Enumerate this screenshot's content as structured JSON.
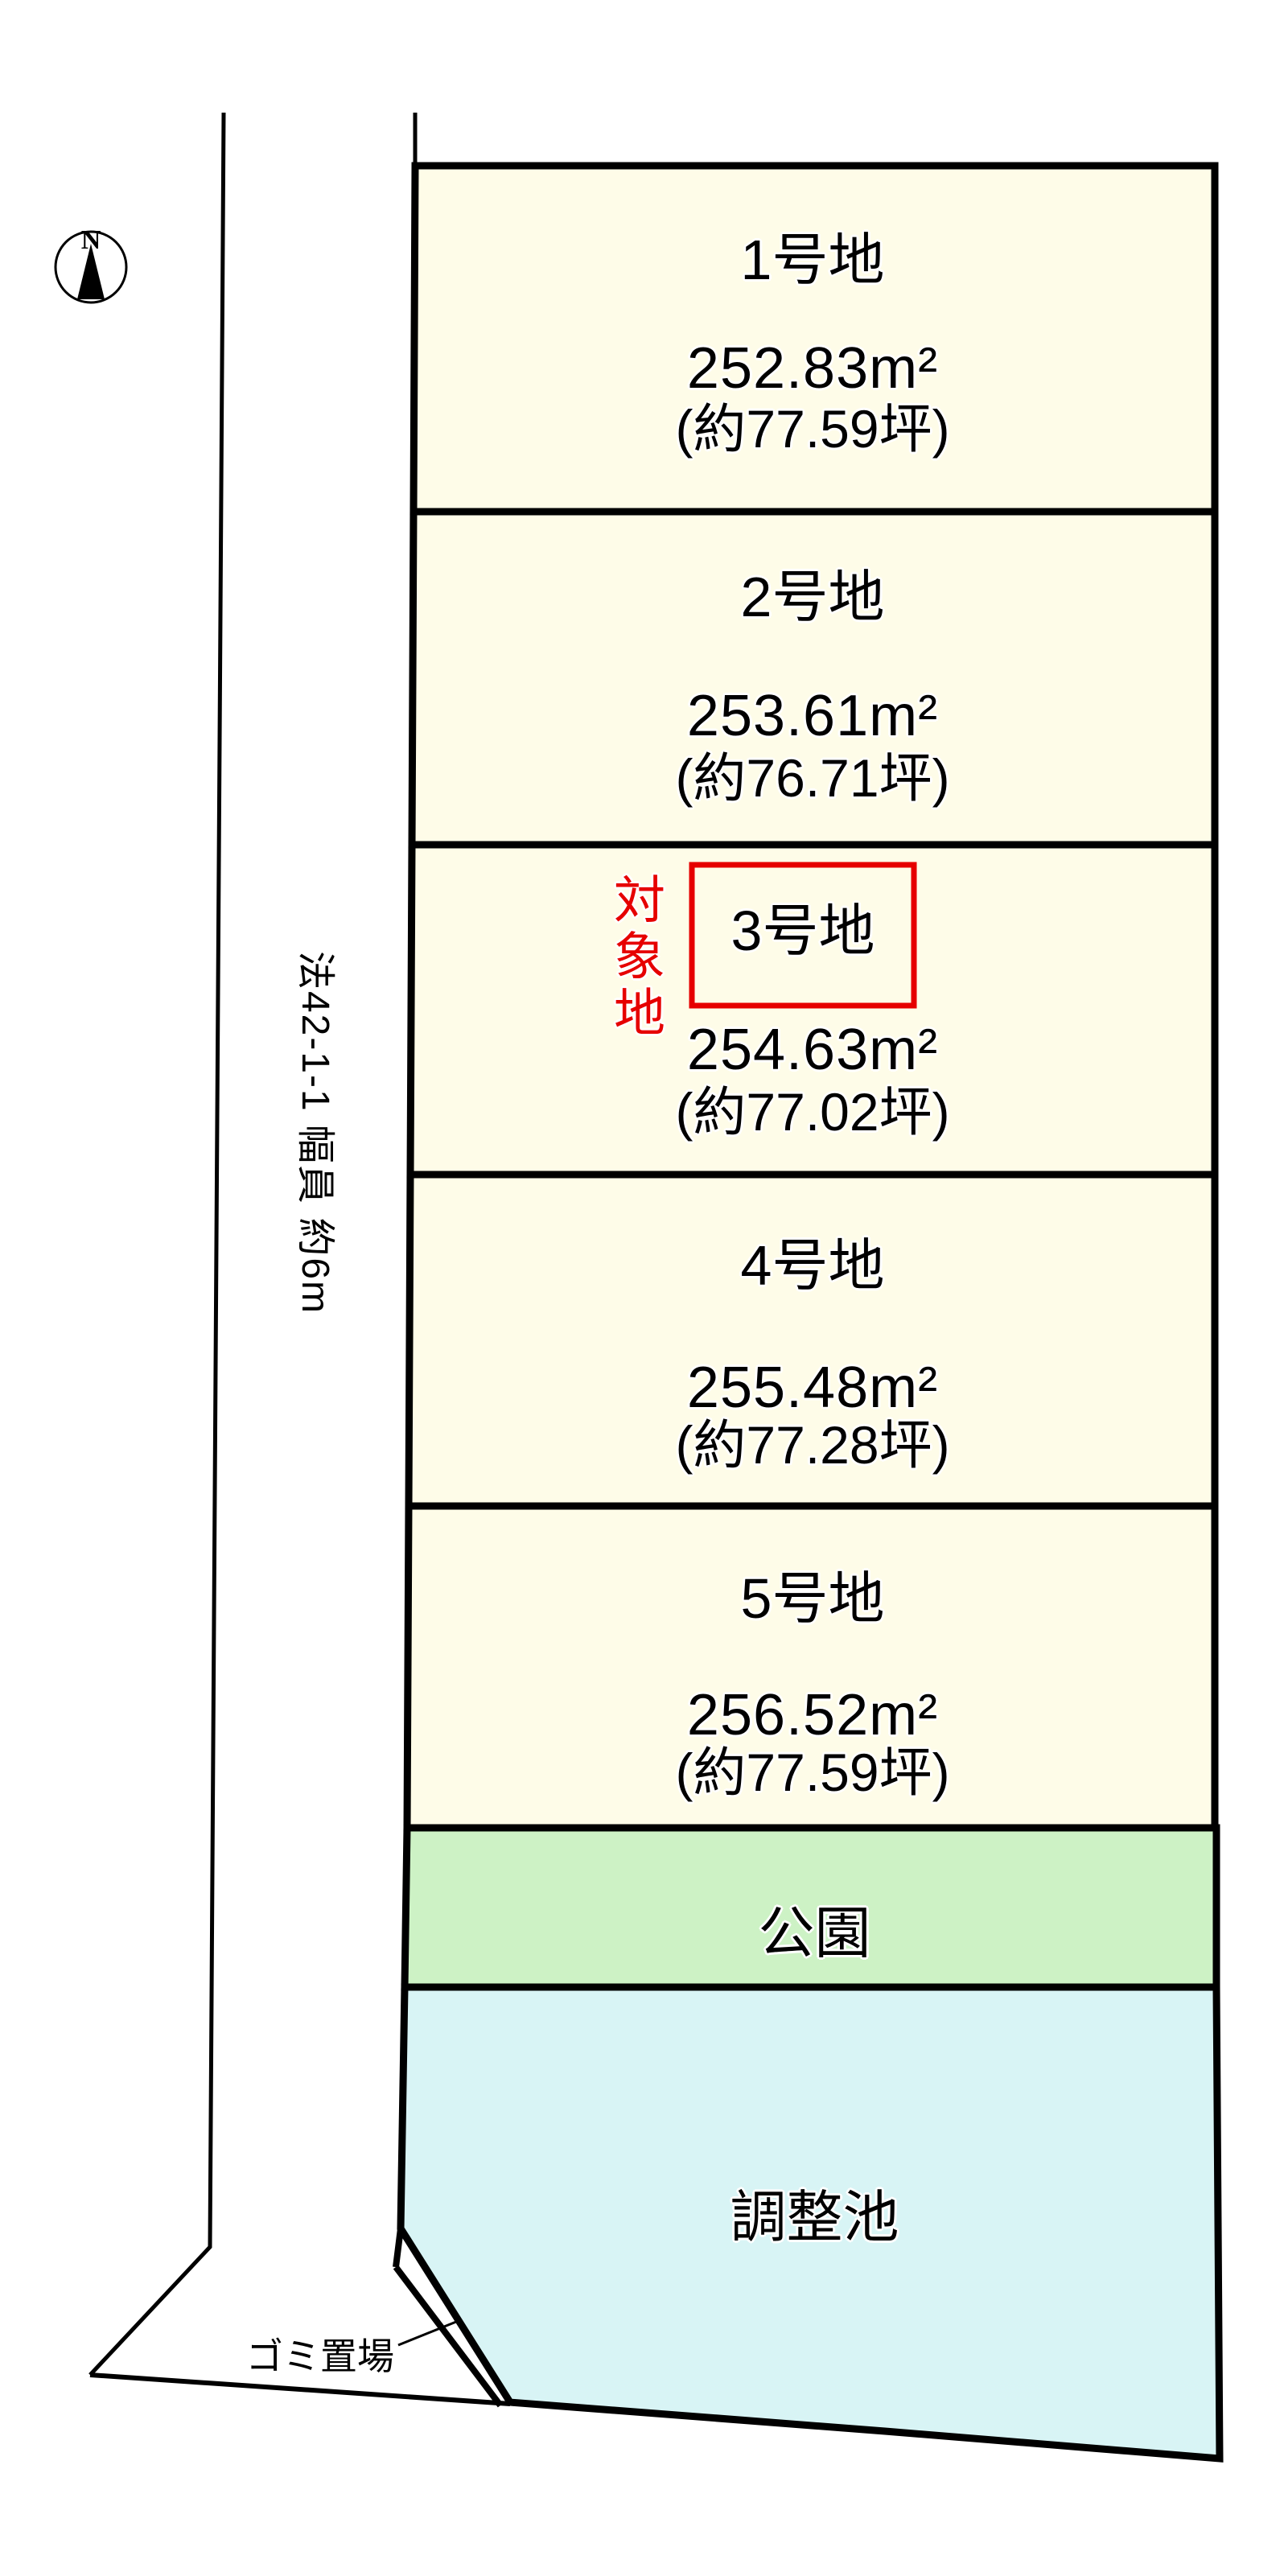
{
  "compass": {
    "north_label": "N"
  },
  "road": {
    "label": "法42-1-1 幅員 約6m"
  },
  "target_marker": {
    "label": "対象地"
  },
  "lots": [
    {
      "title": "1号地",
      "area": "252.83m²",
      "tsubo": "(約77.59坪)"
    },
    {
      "title": "2号地",
      "area": "253.61m²",
      "tsubo": "(約76.71坪)"
    },
    {
      "title": "3号地",
      "area": "254.63m²",
      "tsubo": "(約77.02坪)"
    },
    {
      "title": "4号地",
      "area": "255.48m²",
      "tsubo": "(約77.28坪)"
    },
    {
      "title": "5号地",
      "area": "256.52m²",
      "tsubo": "(約77.59坪)"
    }
  ],
  "park": {
    "label": "公園"
  },
  "pond": {
    "label": "調整池"
  },
  "garbage": {
    "label": "ゴミ置場"
  },
  "colors": {
    "lot_fill": "#fefce8",
    "park_fill": "#cdf2c5",
    "pond_fill": "#d8f4f5",
    "target_red": "#e60000",
    "outline": "#000000"
  }
}
